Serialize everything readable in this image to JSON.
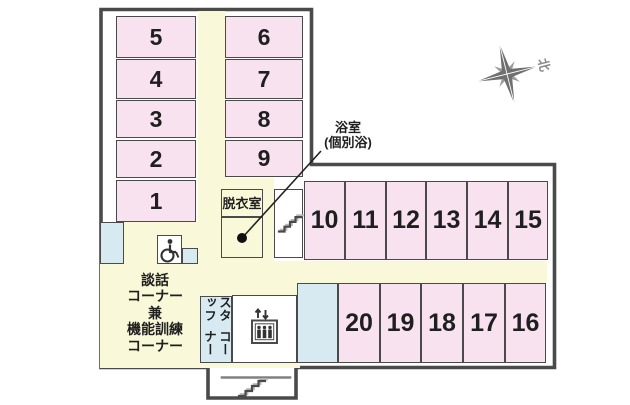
{
  "title": "フロア平面図",
  "palette": {
    "room_pink": "#f9e2f0",
    "corridor_cream": "#f9f9d9",
    "wet_area_blue": "#d7e9f1",
    "wall_gray": "#4a4a4a",
    "text_ink": "#1f1f1f",
    "compass_gray": "#6f6f6f"
  },
  "labels": {
    "bath_line1": "浴室",
    "bath_line2": "(個別浴)",
    "north": "北"
  },
  "lounge": {
    "lines": [
      "談話",
      "コーナー",
      "兼",
      "機能訓練",
      "コーナー"
    ]
  },
  "staff": {
    "line1": "スタッフ",
    "line2": "コーナー"
  },
  "icons": [
    "compass-rose-icon",
    "stairs-icon",
    "wheelchair-icon",
    "elevator-icon",
    "bath-dot-marker"
  ],
  "corridor_areas": [
    {
      "name": "corridor-vertical",
      "x": 198,
      "y": 11,
      "w": 27,
      "h": 254
    },
    {
      "name": "corridor-toilet-area",
      "x": 124,
      "y": 222,
      "w": 74,
      "h": 43
    },
    {
      "name": "lounge-area",
      "x": 100,
      "y": 262,
      "w": 200,
      "h": 106
    },
    {
      "name": "corridor-horizontal",
      "x": 224,
      "y": 261,
      "w": 323,
      "h": 22
    },
    {
      "name": "corridor-bath-area",
      "x": 221,
      "y": 178,
      "w": 53,
      "h": 84
    }
  ],
  "cells": [
    {
      "name": "room-5",
      "label": "5",
      "fill": "pink",
      "fs": 23,
      "x": 116,
      "y": 16,
      "w": 80,
      "h": 42
    },
    {
      "name": "room-4",
      "label": "4",
      "fill": "pink",
      "fs": 23,
      "x": 116,
      "y": 59,
      "w": 80,
      "h": 40
    },
    {
      "name": "room-3",
      "label": "3",
      "fill": "pink",
      "fs": 23,
      "x": 116,
      "y": 100,
      "w": 80,
      "h": 38
    },
    {
      "name": "room-2",
      "label": "2",
      "fill": "pink",
      "fs": 23,
      "x": 116,
      "y": 140,
      "w": 80,
      "h": 38
    },
    {
      "name": "room-1",
      "label": "1",
      "fill": "pink",
      "fs": 23,
      "x": 116,
      "y": 180,
      "w": 80,
      "h": 42
    },
    {
      "name": "room-6",
      "label": "6",
      "fill": "pink",
      "fs": 23,
      "x": 225,
      "y": 16,
      "w": 78,
      "h": 42
    },
    {
      "name": "room-7",
      "label": "7",
      "fill": "pink",
      "fs": 23,
      "x": 225,
      "y": 59,
      "w": 78,
      "h": 40
    },
    {
      "name": "room-8",
      "label": "8",
      "fill": "pink",
      "fs": 23,
      "x": 225,
      "y": 100,
      "w": 78,
      "h": 38
    },
    {
      "name": "room-9",
      "label": "9",
      "fill": "pink",
      "fs": 23,
      "x": 225,
      "y": 140,
      "w": 78,
      "h": 37
    },
    {
      "name": "room-10",
      "label": "10",
      "fill": "pink",
      "fs": 25,
      "x": 304,
      "y": 181,
      "w": 41,
      "h": 79
    },
    {
      "name": "room-11",
      "label": "11",
      "fill": "pink",
      "fs": 25,
      "x": 345,
      "y": 181,
      "w": 41,
      "h": 79
    },
    {
      "name": "room-12",
      "label": "12",
      "fill": "pink",
      "fs": 25,
      "x": 386,
      "y": 181,
      "w": 40,
      "h": 79
    },
    {
      "name": "room-13",
      "label": "13",
      "fill": "pink",
      "fs": 25,
      "x": 426,
      "y": 181,
      "w": 41,
      "h": 79
    },
    {
      "name": "room-14",
      "label": "14",
      "fill": "pink",
      "fs": 25,
      "x": 467,
      "y": 181,
      "w": 41,
      "h": 79
    },
    {
      "name": "room-15",
      "label": "15",
      "fill": "pink",
      "fs": 25,
      "x": 508,
      "y": 181,
      "w": 40,
      "h": 79
    },
    {
      "name": "room-20",
      "label": "20",
      "fill": "pink",
      "fs": 25,
      "x": 338,
      "y": 283,
      "w": 42,
      "h": 80
    },
    {
      "name": "room-19",
      "label": "19",
      "fill": "pink",
      "fs": 25,
      "x": 380,
      "y": 283,
      "w": 41,
      "h": 80
    },
    {
      "name": "room-18",
      "label": "18",
      "fill": "pink",
      "fs": 25,
      "x": 421,
      "y": 283,
      "w": 42,
      "h": 80
    },
    {
      "name": "room-17",
      "label": "17",
      "fill": "pink",
      "fs": 25,
      "x": 463,
      "y": 283,
      "w": 42,
      "h": 80
    },
    {
      "name": "room-16",
      "label": "16",
      "fill": "pink",
      "fs": 25,
      "x": 505,
      "y": 283,
      "w": 41,
      "h": 80
    },
    {
      "name": "utility-room-left",
      "label": "",
      "fill": "blue",
      "x": 100,
      "y": 222,
      "w": 24,
      "h": 42
    },
    {
      "name": "utility-box-small",
      "label": "",
      "fill": "blue",
      "x": 182,
      "y": 248,
      "w": 16,
      "h": 16
    },
    {
      "name": "utility-room-bottom",
      "label": "",
      "fill": "blue",
      "x": 297,
      "y": 283,
      "w": 41,
      "h": 80
    },
    {
      "name": "staff-corner-room",
      "label": "",
      "fill": "blue",
      "x": 200,
      "y": 296,
      "w": 32,
      "h": 67
    },
    {
      "name": "accessible-toilet",
      "label": "",
      "fill": "white",
      "x": 157,
      "y": 235,
      "w": 25,
      "h": 29
    },
    {
      "name": "stairwell-room",
      "label": "",
      "fill": "white",
      "x": 274,
      "y": 189,
      "w": 29,
      "h": 69
    },
    {
      "name": "elevator-room",
      "label": "",
      "fill": "white",
      "x": 232,
      "y": 295,
      "w": 65,
      "h": 68
    },
    {
      "name": "dressing-room",
      "label": "脱衣室",
      "fill": "cream",
      "fs": 13,
      "x": 221,
      "y": 189,
      "w": 42,
      "h": 28
    },
    {
      "name": "bath-room",
      "label": "",
      "fill": "cream",
      "x": 221,
      "y": 217,
      "w": 42,
      "h": 41
    }
  ]
}
